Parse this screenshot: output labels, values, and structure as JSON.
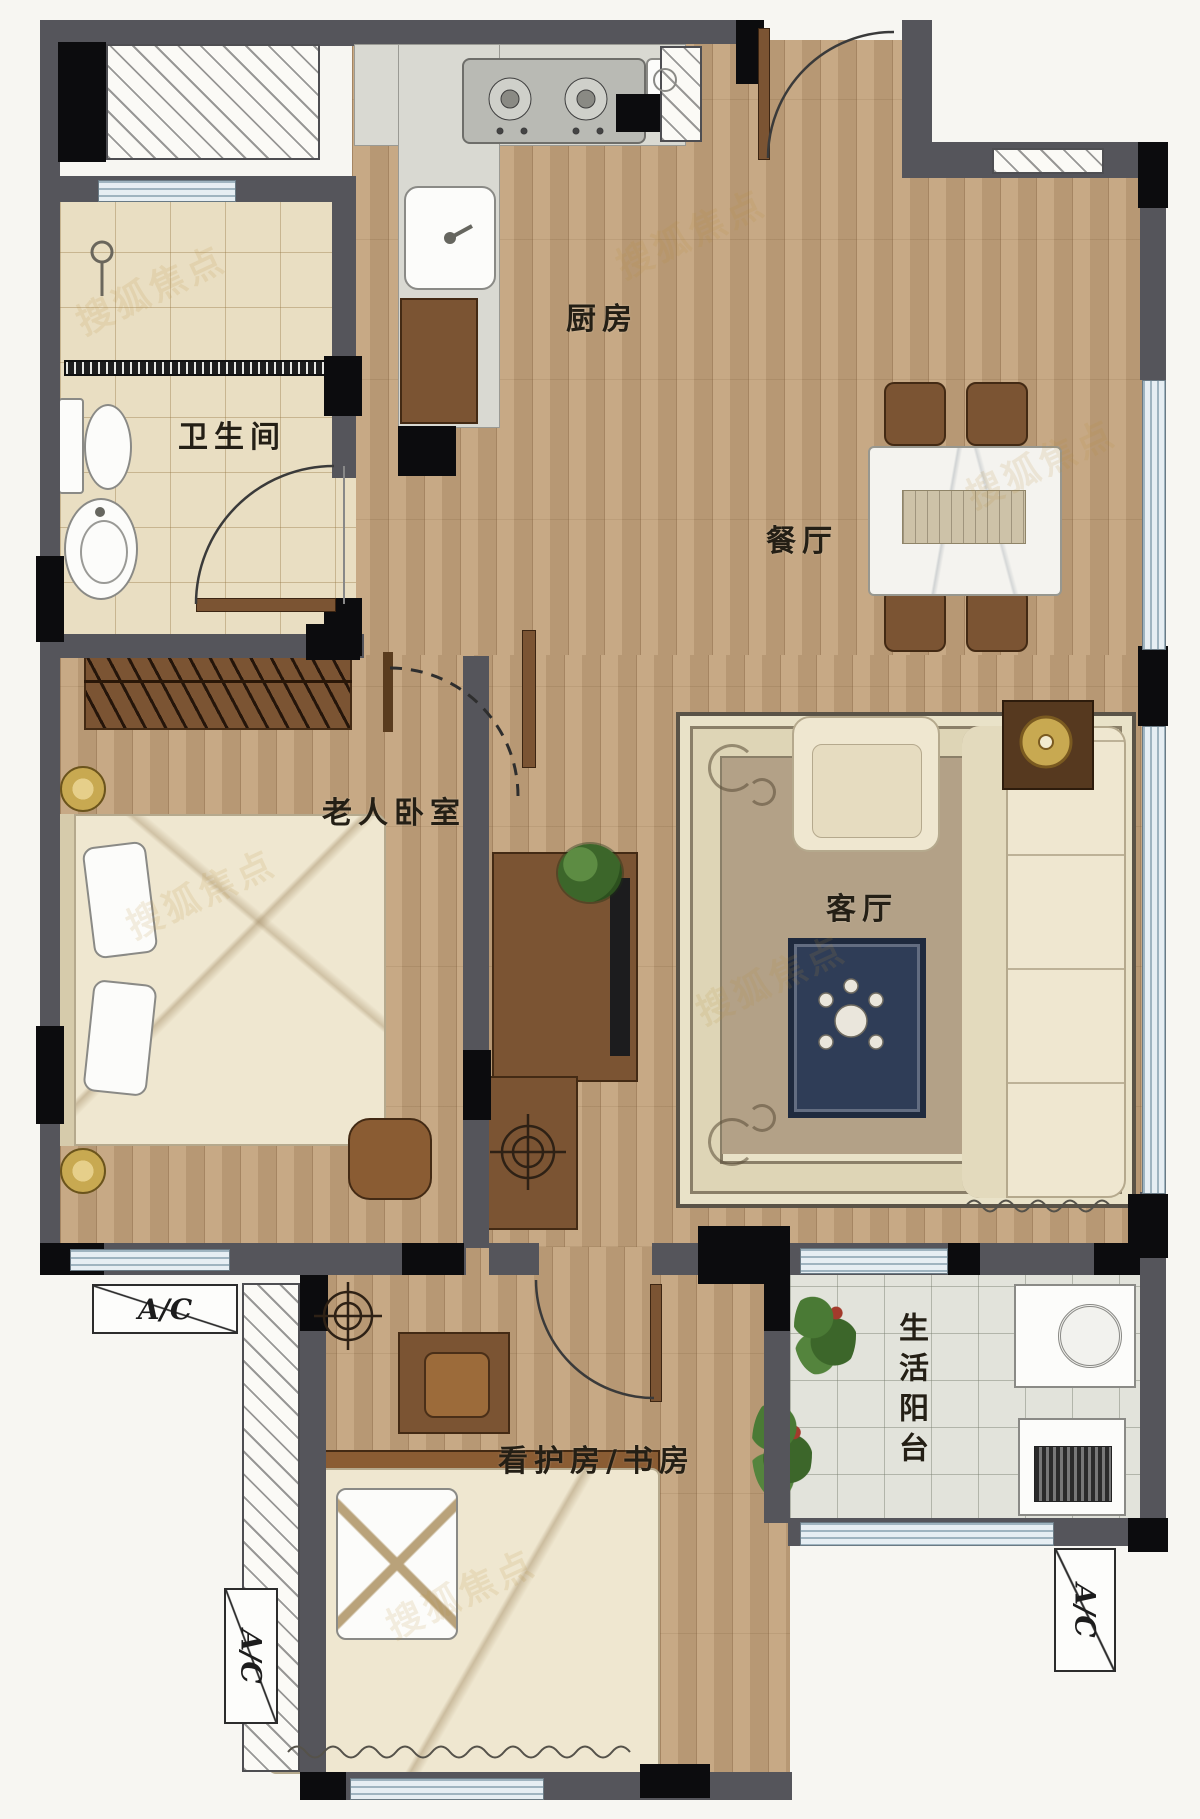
{
  "rooms": {
    "kitchen": "厨房",
    "dining": "餐厅",
    "bathroom": "卫生间",
    "elder_bedroom": "老人卧室",
    "living": "客厅",
    "study": "看护房/书房",
    "balcony": "生活阳台"
  },
  "ac": {
    "left": "A/C",
    "bottom": "A/C",
    "right": "A/C"
  },
  "watermark": "搜狐焦点",
  "colors": {
    "wall": "#55555b",
    "column": "#0c0c0e",
    "wood_floor": "#c2a27b",
    "bath_tile": "#e9dec2",
    "balcony_tile": "#e2e3db",
    "furniture_cream": "#efe7d0",
    "furniture_brown": "#7b5433",
    "coffee_table_navy": "#2f3d57",
    "accent_gold": "#c8a951",
    "window": "#e6eef3"
  }
}
